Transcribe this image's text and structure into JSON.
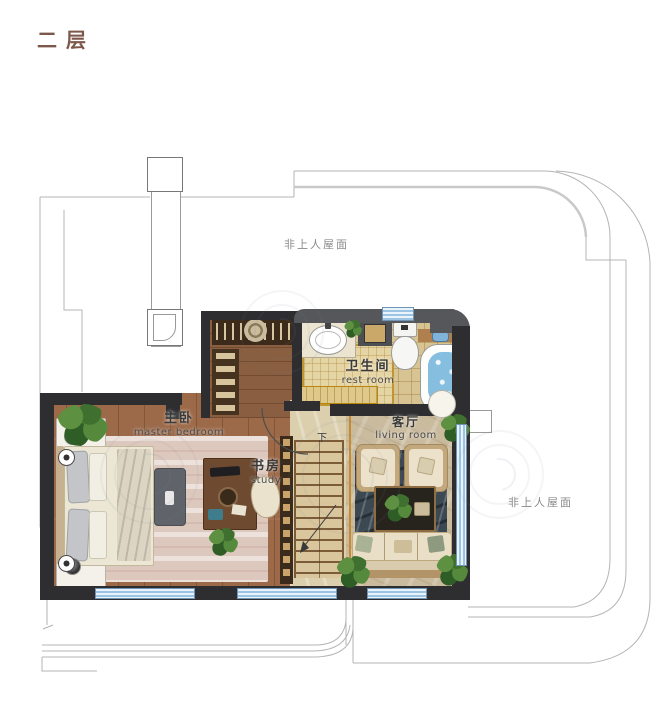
{
  "title": {
    "text": "二层"
  },
  "roof_labels": {
    "top": "非上人屋面",
    "right": "非上人屋面"
  },
  "rooms": {
    "master_bedroom": {
      "name_zh": "主卧",
      "name_en": "master bedroom"
    },
    "study": {
      "name_zh": "书房",
      "name_en": "study"
    },
    "bathroom": {
      "name_zh": "卫生间",
      "name_en": "rest room"
    },
    "living_room": {
      "name_zh": "客厅",
      "name_en": "living room"
    }
  },
  "stairs": {
    "direction_label": "下"
  },
  "colors": {
    "title": "#7c574a",
    "wall": "#2e2e30",
    "roofline": "#b4b4b4",
    "window_blue": "#9cc3e2",
    "wood_floor": "#9d6a49",
    "tile_floor": "#d8c493",
    "living_accent": "#c78a2e",
    "water_blue": "#85bede"
  }
}
